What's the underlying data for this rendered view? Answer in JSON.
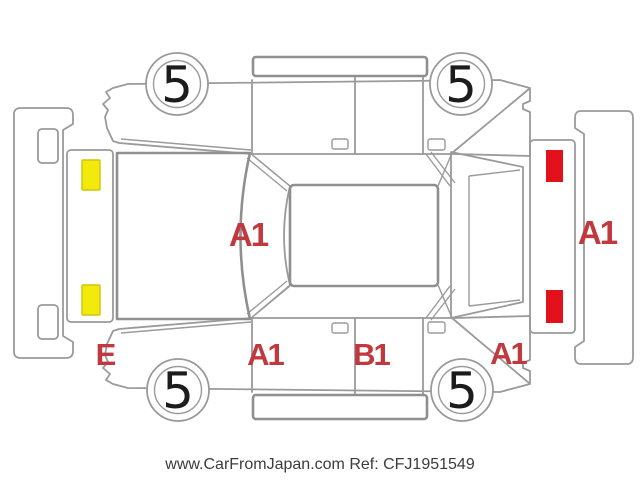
{
  "diagram": {
    "type": "vehicle-inspection-foldout",
    "wheels": [
      {
        "position": "right-front",
        "label": "5"
      },
      {
        "position": "right-rear",
        "label": "5"
      },
      {
        "position": "left-front",
        "label": "5"
      },
      {
        "position": "left-rear",
        "label": "5"
      }
    ],
    "damage_labels": [
      {
        "part": "windshield",
        "code": "A1"
      },
      {
        "part": "rear-bumper",
        "code": "A1"
      },
      {
        "part": "left-front-fender",
        "code": "E"
      },
      {
        "part": "left-front-door",
        "code": "A1"
      },
      {
        "part": "left-rear-door",
        "code": "B1"
      },
      {
        "part": "left-rear-fender",
        "code": "A1"
      }
    ],
    "damage_marks": [
      {
        "part": "front-panel-upper",
        "color": "#f2ea0a"
      },
      {
        "part": "front-panel-lower",
        "color": "#f2ea0a"
      },
      {
        "part": "rear-panel-upper",
        "color": "#e2111c"
      },
      {
        "part": "rear-panel-lower",
        "color": "#e2111c"
      }
    ],
    "colors": {
      "outline": "#9a9a9a",
      "damage_text": "#c0393e",
      "yellow_mark": "#f2ea0a",
      "red_mark": "#e2111c",
      "wheel_text": "#1c1c1c",
      "footer_text": "#3c3c3c",
      "background": "#ffffff"
    }
  },
  "footer": {
    "text": "www.CarFromJapan.com Ref: CFJ1951549"
  }
}
